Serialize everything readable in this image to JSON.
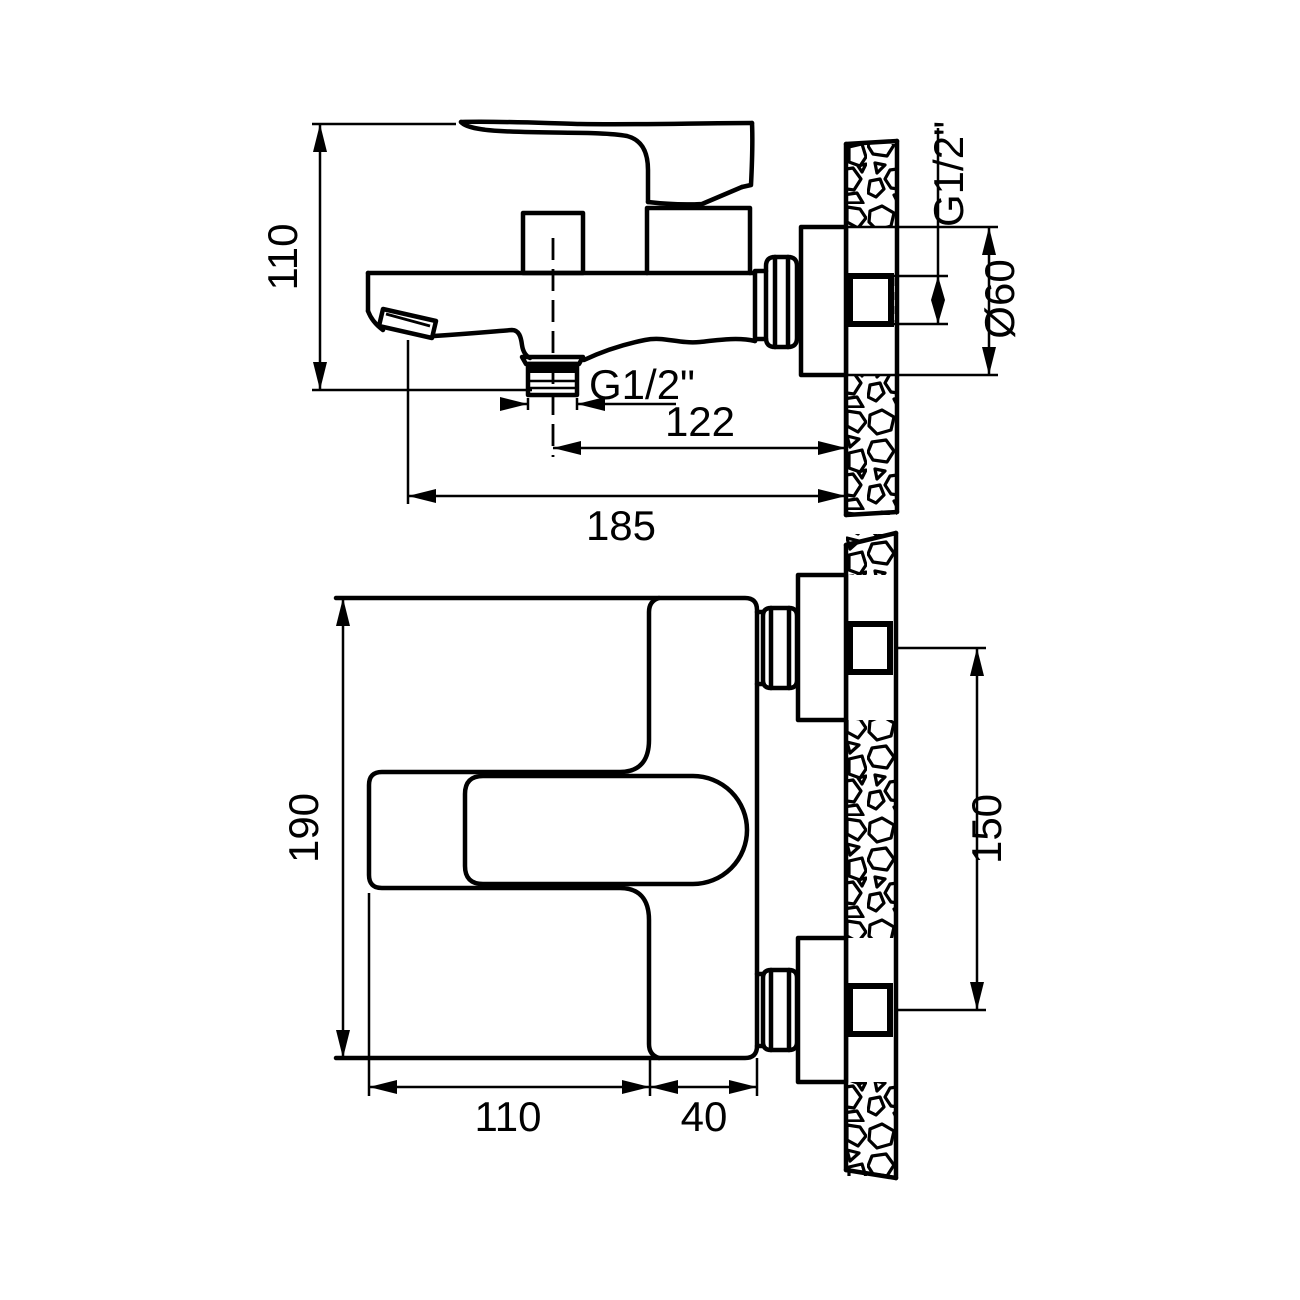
{
  "drawing": {
    "subject": "wall-mounted bath mixer faucet installation drawing",
    "ink_color": "#000000",
    "paper_color": "#ffffff",
    "side_view": {
      "height": "110",
      "outlet_thread": "G1/2\"",
      "center_to_wall": "122",
      "tip_to_wall": "185",
      "wall_thread": "G1/2\"",
      "escutcheon_dia": "Ø60"
    },
    "plan_view": {
      "height": "190",
      "lever_length": "110",
      "body_depth": "40",
      "port_spacing": "150"
    }
  }
}
